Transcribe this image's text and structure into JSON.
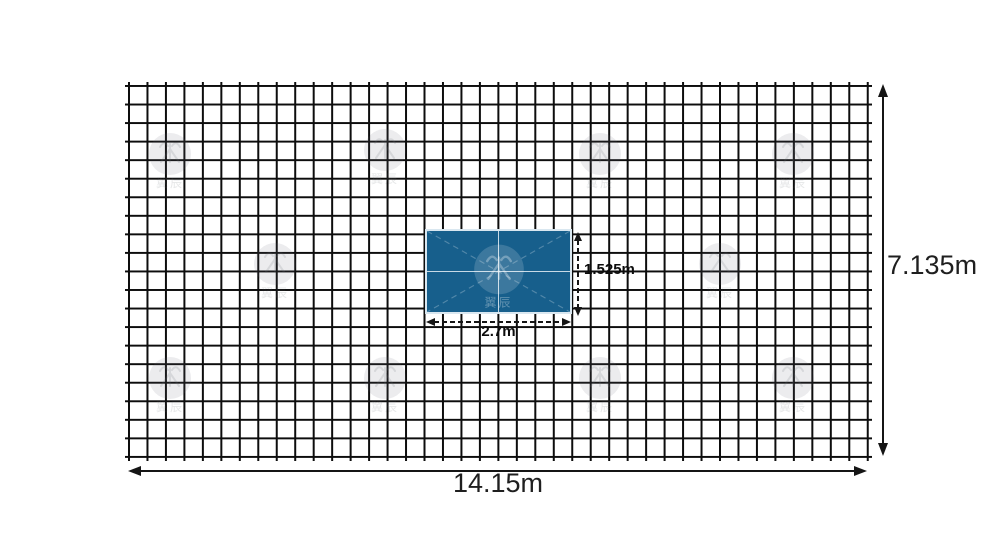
{
  "figure": {
    "wall": {
      "width_label": "14.15m",
      "height_label": "7.135m",
      "grid_columns": 40,
      "grid_rows": 20
    },
    "screen": {
      "width_label": "2.7m",
      "height_label": "1.525m",
      "panel_columns": 2,
      "panel_rows": 2,
      "fill_color": "#175f8c",
      "border_color": "#d9e7f0"
    },
    "watermark_text": "翼辰"
  }
}
